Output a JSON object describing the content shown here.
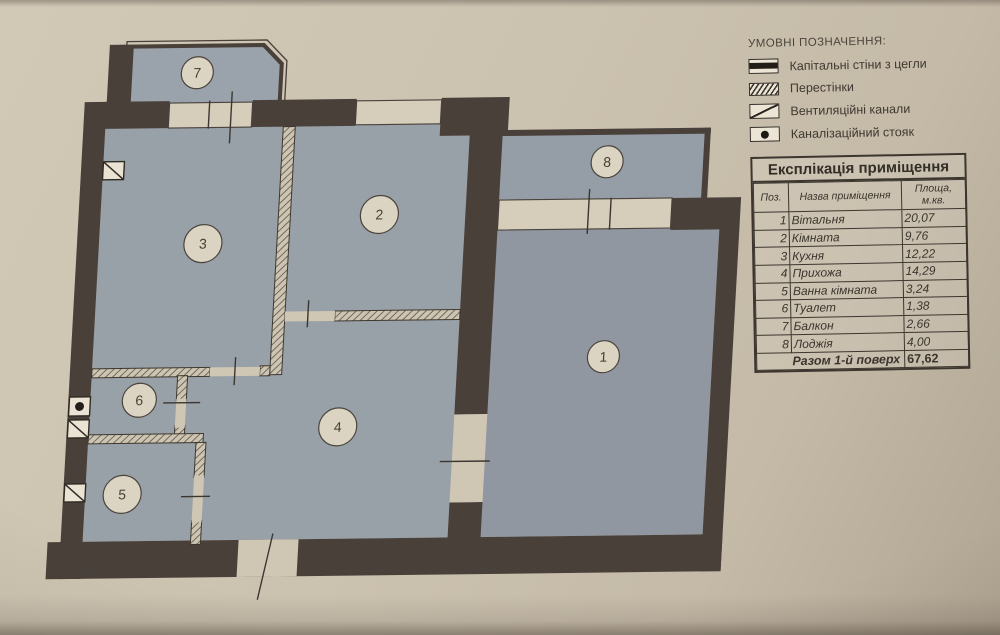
{
  "legend": {
    "title": "УМОВНІ ПОЗНАЧЕННЯ:",
    "items": [
      {
        "icon": "brick-wall-icon",
        "label": "Капітальні стіни з цегли"
      },
      {
        "icon": "partition-icon",
        "label": "Перестінки"
      },
      {
        "icon": "vent-channel-icon",
        "label": "Вентиляційні канали"
      },
      {
        "icon": "sewer-riser-icon",
        "label": "Каналізаційний стояк"
      }
    ]
  },
  "table": {
    "title": "Експлікація приміщення",
    "columns": [
      "Поз.",
      "Назва приміщення",
      "Площа, м.кв."
    ],
    "rows": [
      {
        "pos": "1",
        "name": "Вітальня",
        "area": "20,07"
      },
      {
        "pos": "2",
        "name": "Кімната",
        "area": "9,76"
      },
      {
        "pos": "3",
        "name": "Кухня",
        "area": "12,22"
      },
      {
        "pos": "4",
        "name": "Прихожа",
        "area": "14,29"
      },
      {
        "pos": "5",
        "name": "Ванна кімната",
        "area": "3,24"
      },
      {
        "pos": "6",
        "name": "Туалет",
        "area": "1,38"
      },
      {
        "pos": "7",
        "name": "Балкон",
        "area": "2,66"
      },
      {
        "pos": "8",
        "name": "Лоджія",
        "area": "4,00"
      }
    ],
    "total_label": "Разом 1-й поверх",
    "total_value": "67,62"
  },
  "plan": {
    "rooms": [
      {
        "number": "1",
        "name": "Вітальня"
      },
      {
        "number": "2",
        "name": "Кімната"
      },
      {
        "number": "3",
        "name": "Кухня"
      },
      {
        "number": "4",
        "name": "Прихожа"
      },
      {
        "number": "5",
        "name": "Ванна кімната"
      },
      {
        "number": "6",
        "name": "Туалет"
      },
      {
        "number": "7",
        "name": "Балкон"
      },
      {
        "number": "8",
        "name": "Лоджія"
      }
    ]
  },
  "colors": {
    "photo_background": "#cabfae",
    "room_fill": "#98a0a8",
    "wall": "#49403a",
    "window_band": "#d6cdbb",
    "circle_fill": "#dcd4c2",
    "ink": "#3c362e"
  }
}
